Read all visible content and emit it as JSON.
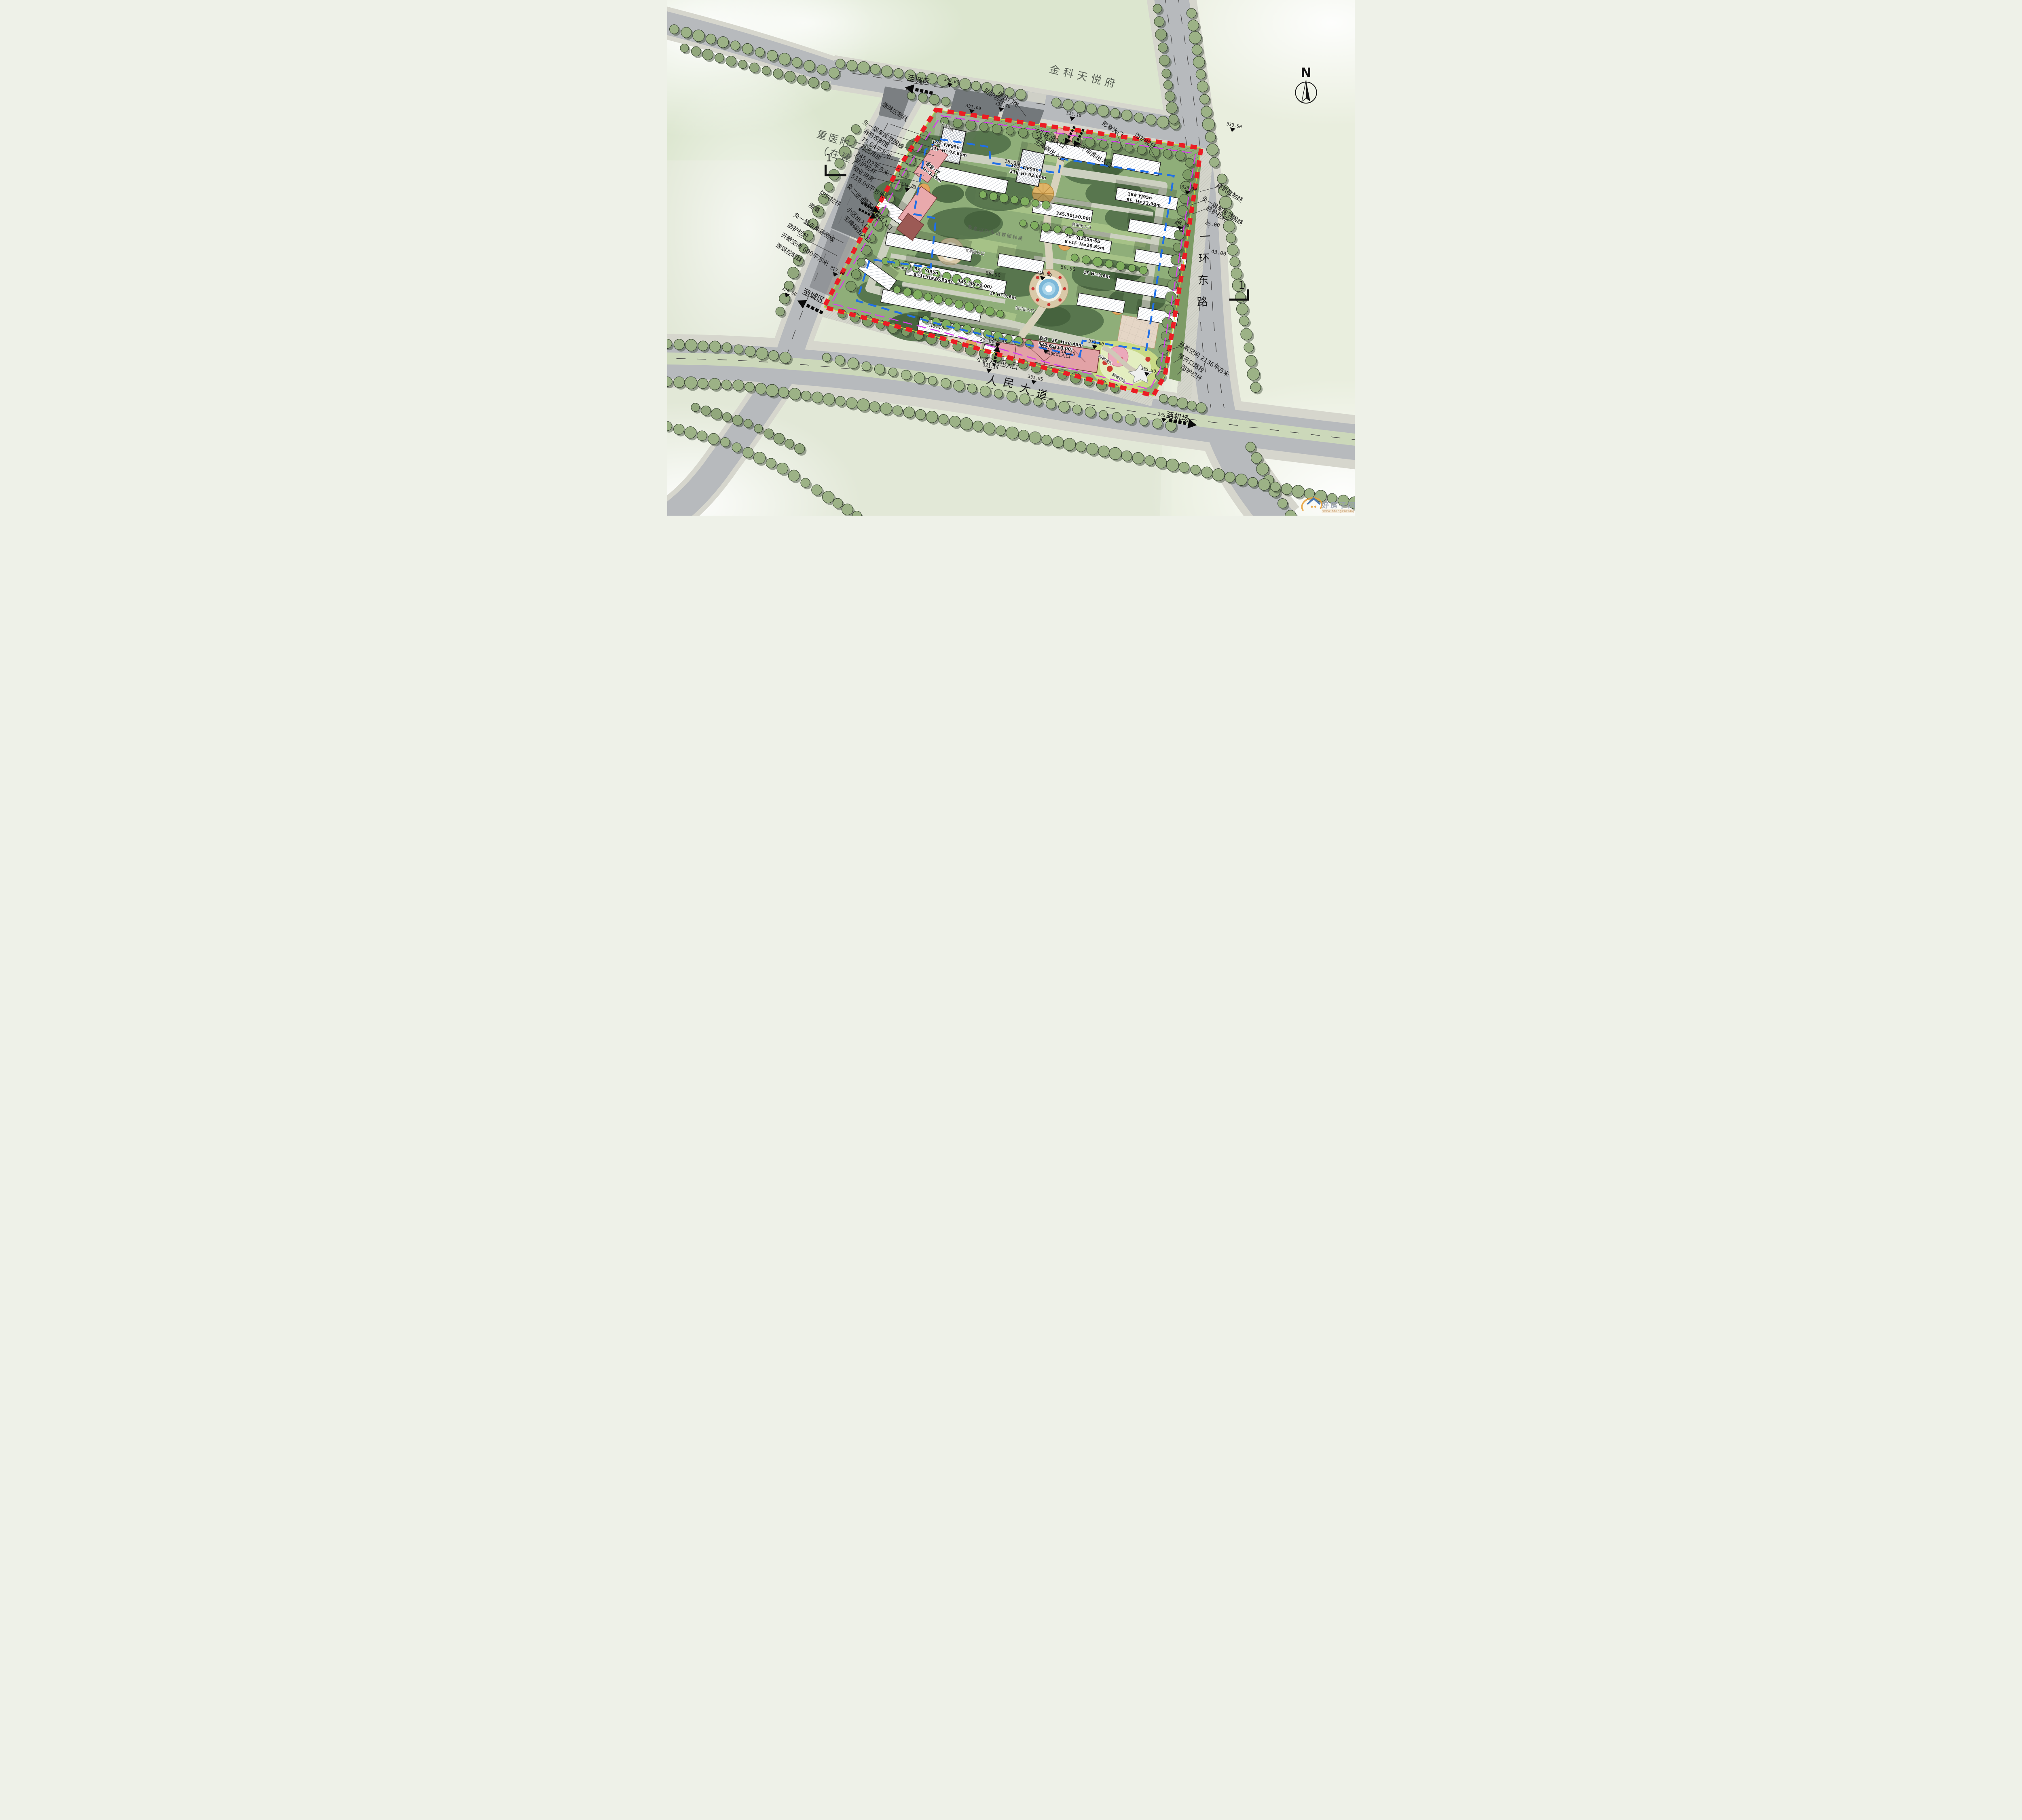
{
  "labels": {
    "north_estate": "金科天悦府",
    "hospital_name": "重医附二院",
    "hospital_status": "（在建）",
    "renmin_avenue": "人民大道",
    "yihuan_east_road": "一环东路",
    "to_city": "至城区",
    "to_airport": "至机场",
    "compass_n": "N",
    "section_no": "1",
    "guard_rail": "防护栏杆",
    "gate_post": "综合门岗",
    "community_entrance": "小区出入口",
    "barrier_free_entrance": "无障碍出入口",
    "garage_entrance": "地下车库出入口",
    "image_gate": "形象大门",
    "garage_line_b1": "负一层车库范围线",
    "garage_line_b2": "负二层车库范围线",
    "fire_control_room": "消防控制室",
    "fire_control_area": "75.64平方米",
    "community_room": "社区用房",
    "community_area": "245.02平方米",
    "property_room": "物业用房",
    "property_area": "518.96平方米",
    "fence_wall": "围墙",
    "open_space_600": "开敞空间  600平方米",
    "open_space_2136": "开敞空间  2136平方米",
    "no_opening_section": "禁开口路段",
    "building_control_line": "建筑控制线",
    "pedestrian_entrance": "小区人行出入口",
    "commercial_entrance": "商业出入口",
    "residence_entrance": "住宅出入口",
    "fire_lane": "紧急消防车道兼园林路",
    "slope_green": "斜坡绿化",
    "slope_12": "1:2放坡"
  },
  "buildings": [
    {
      "no": "19#",
      "model": "YJF95n",
      "floors": "31F",
      "height": "H=93.60m"
    },
    {
      "no": "18#",
      "model": "YJF95n",
      "floors": "31F",
      "height": "H=93.60m"
    },
    {
      "no": "5#",
      "model": "YJ95n",
      "floors": "8+1F",
      "height": "H=26.85m"
    },
    {
      "no": "7#",
      "model": "YJ115n-6b",
      "floors": "8+1F",
      "height": "H=26.85m"
    },
    {
      "no": "16#",
      "model": "YJ95n",
      "floors": "8F",
      "height": "H=23.90m"
    },
    {
      "no": "配套-1F",
      "model": "",
      "floors": "1F",
      "height": "H=3.15m"
    },
    {
      "no": "商业",
      "model": "",
      "floors": "2F",
      "height": "H=8.45m"
    }
  ],
  "commons": {
    "zero_level": "335.30(±0.00)",
    "commercial_level": "332.65(±0.00)",
    "one_f": "1F  H=3.6m",
    "unit": "一单元"
  },
  "elevations": [
    "330.80",
    "331.00",
    "332.70",
    "333.10",
    "333.50",
    "333.30",
    "334.58",
    "335.00",
    "335.50",
    "333.00",
    "331.15",
    "331.95",
    "326.50",
    "327.20",
    "335.00",
    "334.85",
    "331.45",
    "332.50"
  ],
  "dims": [
    "21.02",
    "45.00",
    "43.00",
    "19.50",
    "68.00",
    "56.90",
    "54.20",
    "25.00",
    "30.10",
    "18.00"
  ],
  "watermark": {
    "site_name": "好房子网",
    "site_url": "www.hfangziwang.com"
  }
}
